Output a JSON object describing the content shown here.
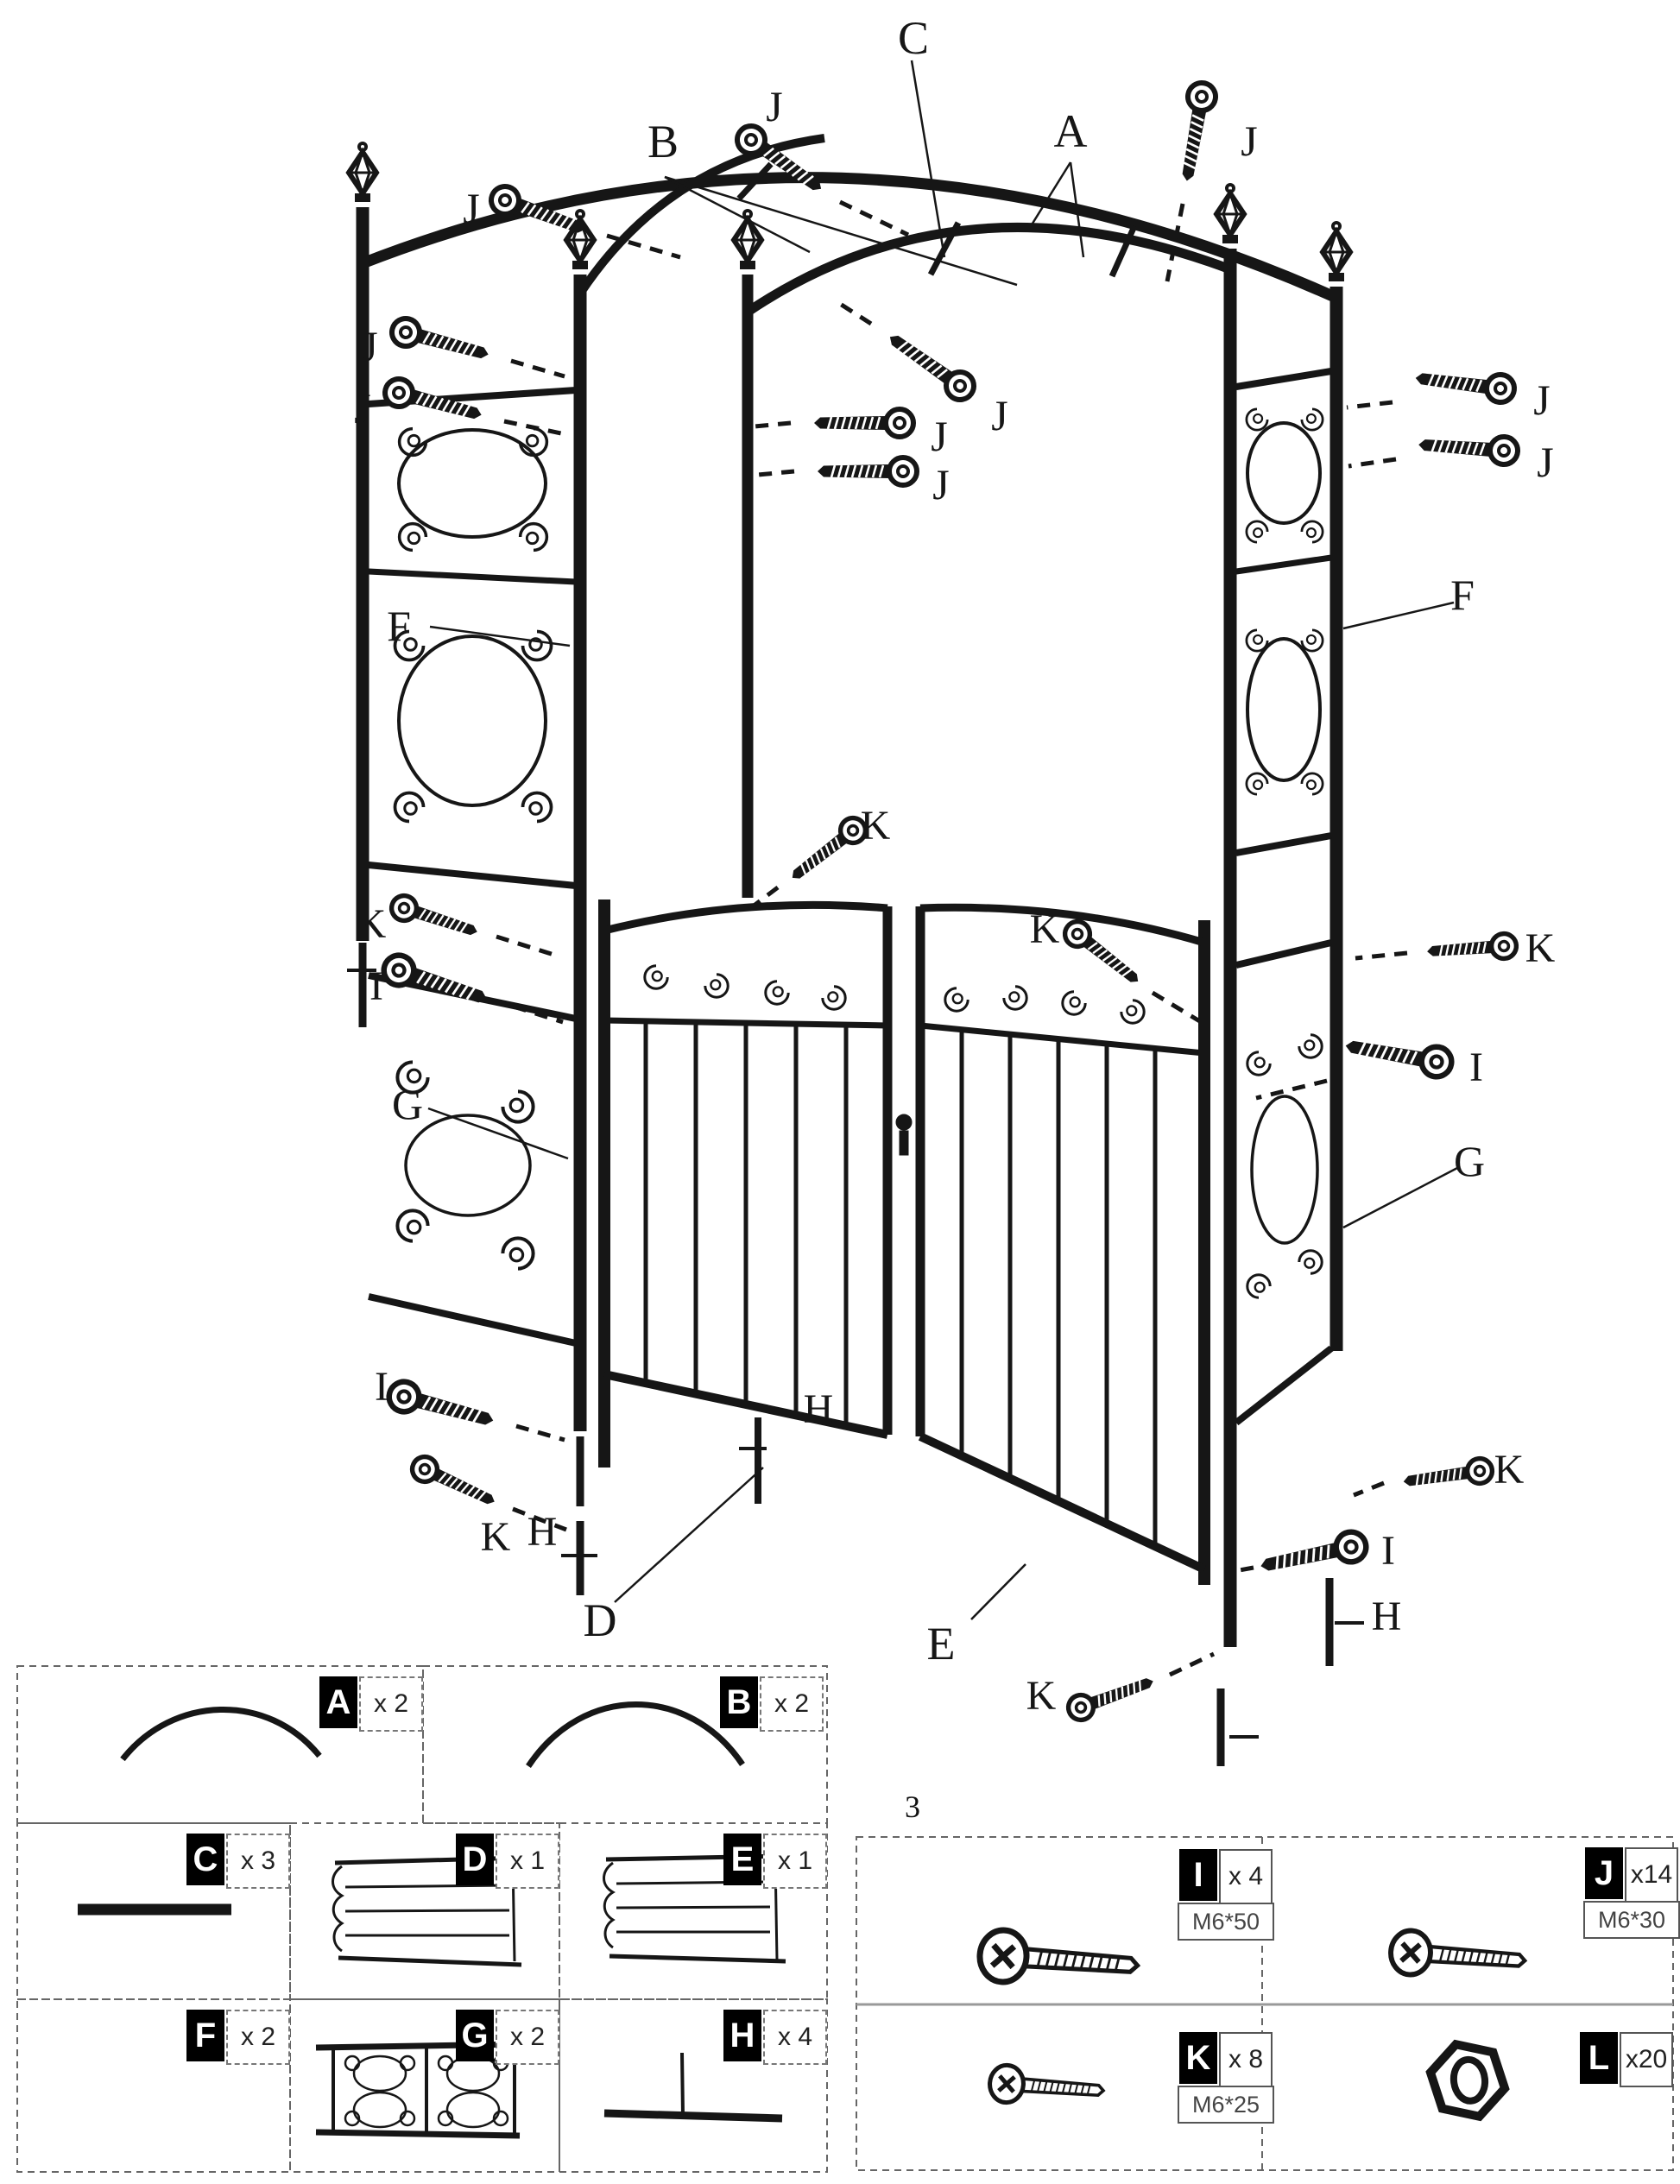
{
  "page": {
    "fragment": "3"
  },
  "labels": {
    "A": "A",
    "B": "B",
    "C": "C",
    "D": "D",
    "E": "E",
    "F": "F",
    "G": "G",
    "H": "H",
    "I": "I",
    "J": "J",
    "K": "K",
    "L": "L"
  },
  "parts_list": [
    {
      "id": "A",
      "count": "x 2"
    },
    {
      "id": "B",
      "count": "x 2"
    },
    {
      "id": "C",
      "count": "x 3"
    },
    {
      "id": "D",
      "count": "x 1"
    },
    {
      "id": "E",
      "count": "x 1"
    },
    {
      "id": "F",
      "count": "x 2"
    },
    {
      "id": "G",
      "count": "x 2"
    },
    {
      "id": "H",
      "count": "x 4"
    }
  ],
  "hardware_list": [
    {
      "id": "I",
      "count": "x 4",
      "spec": "M6*50"
    },
    {
      "id": "J",
      "count": "x14",
      "spec": "M6*30"
    },
    {
      "id": "K",
      "count": "x 8",
      "spec": "M6*25"
    },
    {
      "id": "L",
      "count": "x20"
    }
  ],
  "colors": {
    "ink": "#161616",
    "box_border": "#666666",
    "chip_bg": "#000000",
    "chip_text": "#ffffff"
  }
}
